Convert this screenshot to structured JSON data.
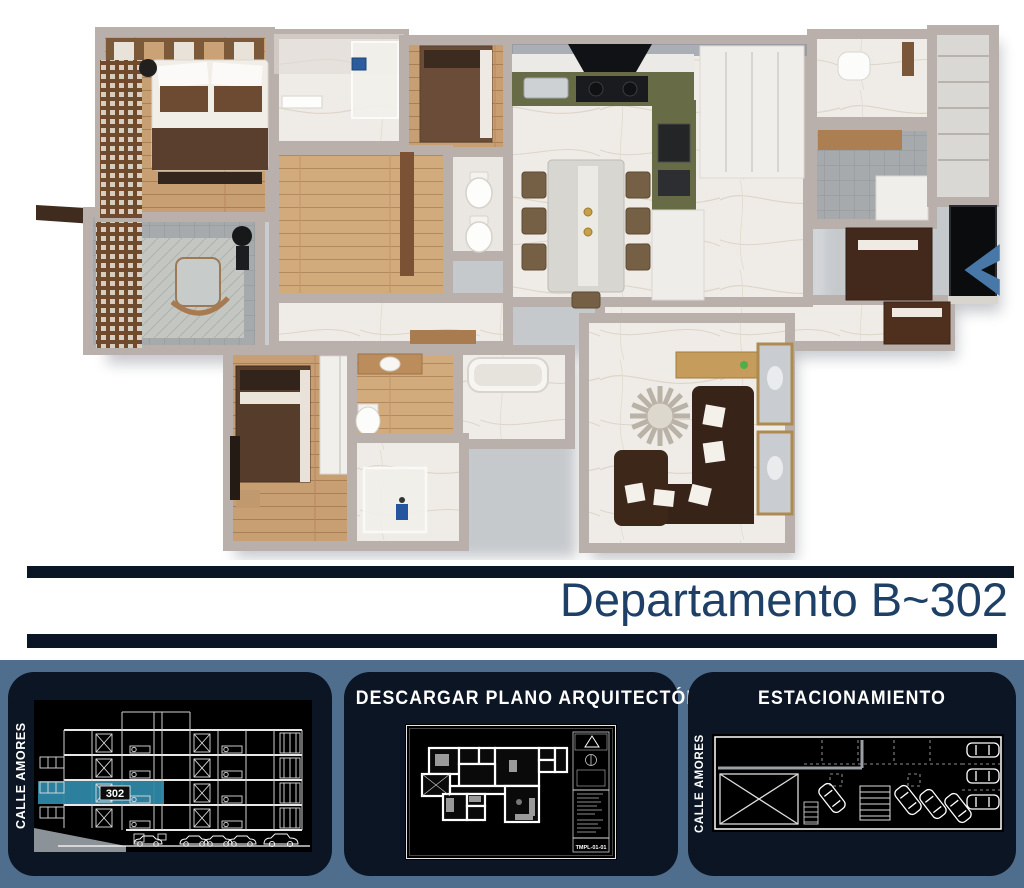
{
  "title": {
    "text": "Departamento B~302"
  },
  "carousel": {
    "direction": "prev"
  },
  "footer": {
    "building_section": {
      "street_label": "CALLE AMORES",
      "unit_label": "302"
    },
    "download": {
      "title": "DESCARGAR PLANO ARQUITECTÓNICO",
      "sheet_code": "TMPL-01-01"
    },
    "parking": {
      "title": "ESTACIONAMIENTO",
      "street_label": "CALLE AMORES"
    }
  },
  "colors": {
    "slate_bg": "#4f6e8e",
    "panel_bg": "#0b1523",
    "bar_navy": "#0a1626",
    "title_navy": "#1e3f66",
    "teal_highlight": "#2e87a5",
    "arrow_blue": "#4878a8"
  }
}
